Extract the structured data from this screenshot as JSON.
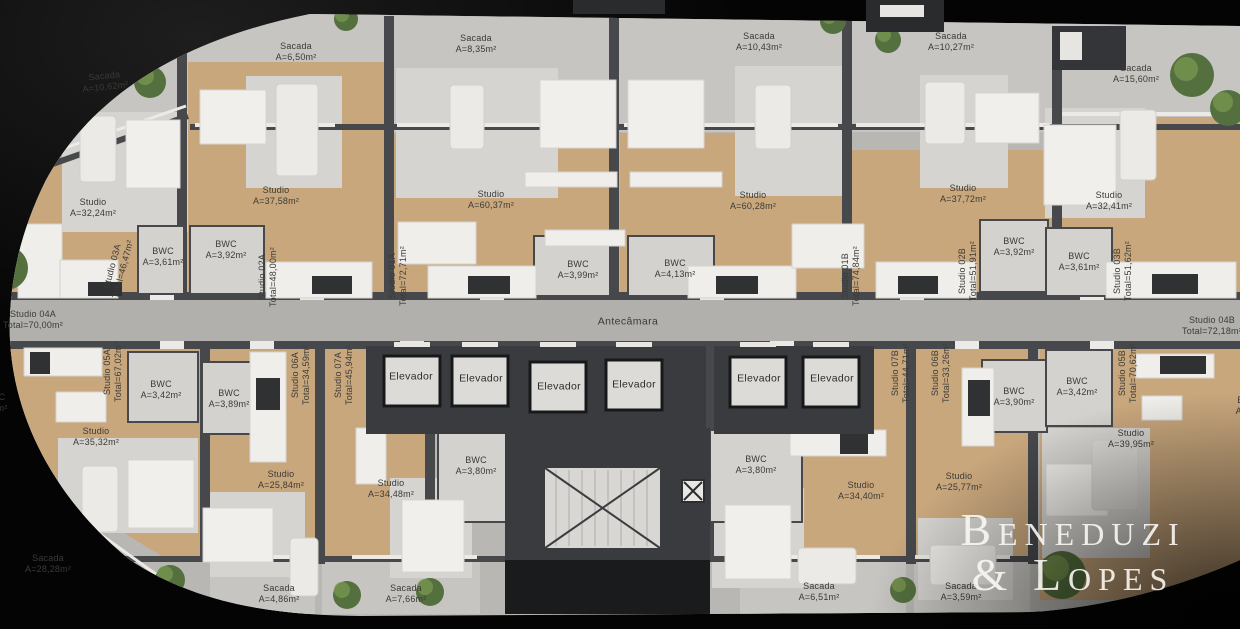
{
  "branding": {
    "watermark_line1": "Beneduzi",
    "watermark_line2": "& Lopes"
  },
  "core": {
    "antechamber": "Antecâmara",
    "elevator": "Elevador"
  },
  "units": {
    "s01a": {
      "unit": "Studio 01A\nTotal=72,71m²",
      "area": "Studio\nA=60,37m²",
      "bwc": "BWC\nA=3,99m²",
      "balcony": "Sacada\nA=8,35m²"
    },
    "s01b": {
      "unit": "Studio 01B\nTotal=74,84m²",
      "area": "Studio\nA=60,28m²",
      "bwc": "BWC\nA=4,13m²",
      "balcony": "Sacada\nA=10,43m²"
    },
    "s02a": {
      "unit": "Studio 02A\nTotal=48,00m²",
      "area": "Studio\nA=37,58m²",
      "bwc": "BWC\nA=3,92m²",
      "balcony": "Sacada\nA=6,50m²"
    },
    "s02b": {
      "unit": "Studio 02B\nTotal=51,91m²",
      "area": "Studio\nA=37,72m²",
      "bwc": "BWC\nA=3,92m²",
      "balcony": "Sacada\nA=10,27m²"
    },
    "s03a": {
      "unit": "Studio 03A\nTotal=46,47m²",
      "area": "Studio\nA=32,24m²",
      "bwc": "BWC\nA=3,61m²",
      "balcony": "Sacada\nA=10,62m²"
    },
    "s03b": {
      "unit": "Studio 03B\nTotal=51,62m²",
      "area": "Studio\nA=32,41m²",
      "bwc": "BWC\nA=3,61m²",
      "balcony": "Sacada\nA=15,60m²"
    },
    "s04a": {
      "unit": "Studio 04A\nTotal=70,00m²"
    },
    "s04b": {
      "unit": "Studio 04B\nTotal=72,18m²"
    },
    "s05a": {
      "unit": "Studio 05A\nTotal=67,02m²",
      "area": "Studio\nA=35,32m²",
      "bwc": "BWC\nA=3,42m²",
      "balcony": "Sacada\nA=28,28m²"
    },
    "s05b": {
      "unit": "Studio 05B\nTotal=70,62m²",
      "area": "Studio\nA=39,95m²",
      "bwc": "BWC\nA=3,42m²"
    },
    "s06a": {
      "unit": "Studio 06A\nTotal=34,59m²",
      "area": "Studio\nA=25,84m²",
      "bwc": "BWC\nA=3,89m²",
      "balcony": "Sacada\nA=4,86m²"
    },
    "s06b": {
      "unit": "Studio 06B\nTotal=33,26m²",
      "area": "Studio\nA=25,77m²",
      "bwc": "BWC\nA=3,90m²",
      "balcony": "Sacada\nA=3,59m²"
    },
    "s07a": {
      "unit": "Studio 07A\nTotal=45,94m²",
      "area": "Studio\nA=34,48m²",
      "bwc": "BWC\nA=3,80m²",
      "balcony": "Sacada\nA=7,66m²"
    },
    "s07b": {
      "unit": "Studio 07B\nTotal=44,71m²",
      "area": "Studio\nA=34,40m²",
      "bwc": "BWC\nA=3,80m²",
      "balcony": "Sacada\nA=6,51m²"
    }
  },
  "partials": {
    "right_bwc": "BWC\nA=4,0",
    "left_fragment": "C\nm²"
  },
  "colors": {
    "slab": "#bab9b5",
    "balcony": "#c6c5c1",
    "wood": "#c9a77d",
    "wall": "#46484b",
    "core": "#393b3e",
    "rug": "#d6d4d0",
    "furniture": "#efeeea",
    "plant": "#55703f",
    "text": "#3b3a36"
  }
}
